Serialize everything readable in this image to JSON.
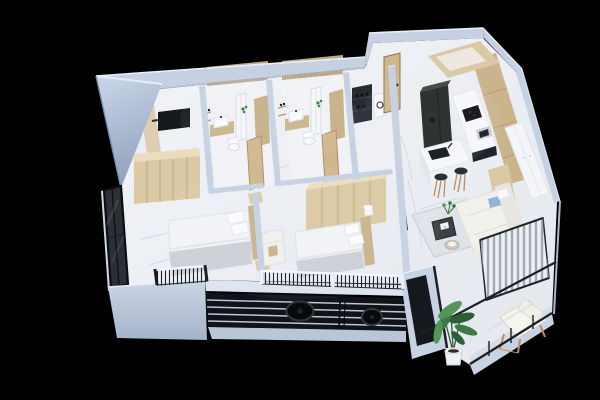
{
  "scene": {
    "kind": "isometric-3d-apartment-cutaway-render",
    "background": "black",
    "rooms": [
      {
        "name": "master-bedroom",
        "furniture": [
          "double-bed",
          "pillows",
          "gray-throw",
          "wardrobe",
          "wall-tv",
          "nightstand",
          "corner-glass-window",
          "juliet-railing"
        ]
      },
      {
        "name": "bedroom-2",
        "furniture": [
          "double-bed",
          "pillows",
          "wardrobe",
          "dresser",
          "chair",
          "table-lamp",
          "front-railing"
        ]
      },
      {
        "name": "bathroom-1",
        "furniture": [
          "wood-slat-wall",
          "mirror-cabinet",
          "vanity-sink",
          "wall-shelves",
          "toilet",
          "shower-partition",
          "wood-door",
          "plant-accent"
        ]
      },
      {
        "name": "bathroom-2",
        "furniture": [
          "wood-slat-wall",
          "mirror-cabinet",
          "vanity-sink",
          "wall-shelves",
          "toilet",
          "shower-partition",
          "wood-door",
          "plant-accent"
        ]
      },
      {
        "name": "utility-room",
        "furniture": [
          "dark-shelf-unit",
          "white-appliance"
        ]
      },
      {
        "name": "entry-hall",
        "furniture": [
          "entry-door"
        ]
      },
      {
        "name": "kitchen",
        "furniture": [
          "tall-dark-cabinet",
          "upper-cabinets",
          "counter-with-cooktop",
          "oven",
          "island-with-sink",
          "bar-stool",
          "bar-stool",
          "wood-cabinet-wall"
        ]
      },
      {
        "name": "living-room",
        "furniture": [
          "sofa",
          "blue-pillow",
          "rug",
          "coffee-table",
          "side-table",
          "small-plant",
          "wall-tv",
          "built-in-closet"
        ]
      },
      {
        "name": "balcony",
        "furniture": [
          "lounge-chair",
          "potted-banana-plant",
          "striped-privacy-screen",
          "glass-railing"
        ]
      },
      {
        "name": "service-ledge",
        "furniture": [
          "louver-grille",
          "condenser-fan-large",
          "condenser-fan-small",
          "open-trough"
        ]
      }
    ]
  },
  "palette": {
    "background": "#000000",
    "wall_band": "#c5d1e2",
    "wall_rim": "#e9eff8",
    "wall_shadow": "#93a5bf",
    "wall_face": "#e8edf5",
    "floor": "#eceef2",
    "floor_vein": "#d0d5dc",
    "fascia": "#c7d2e2",
    "under_fascia": "#b9c6d8",
    "louver_dark": "#101317",
    "louver_slat": "#c7d0dc",
    "fan_dark": "#07090b",
    "fan_ring": "#32383f",
    "trough_dark": "#15191d",
    "wood_light": "#dbc9a5",
    "wood_mid": "#c9b48c",
    "wood_dark": "#b59e78",
    "wood_seam": "#a98f68",
    "slat_wall": "#c3ad89",
    "door_wood": "#cfb68c",
    "cabinet_dark": "#232a28",
    "cabinet_dark_top": "#3a453f",
    "appliance_dark": "#0e1012",
    "counter": "#f6f7fa",
    "fixture": "#f8f9fb",
    "mirror": "#f4f6f8",
    "textile": "#f2f3f6",
    "throw_gray": "#ccd0d6",
    "pillow_blue": "#8fb3d9",
    "glass": "#2b3036",
    "frame_dark": "#0b0d10",
    "railing_dark": "#1d2126",
    "railing_white": "#f2f5f9",
    "rug": "#dfe2e6",
    "rug_border": "#d0d4da",
    "sofa": "#f1f0ec",
    "sofa_shade": "#e7e6e1",
    "table_dark": "#3b4046",
    "side_table": "#cfc9bd",
    "stool_seat": "#2a2f33",
    "stool_leg": "#b98f5f",
    "screen_base": "#eef0f3",
    "screen_stripe": "#98a2ac",
    "plant": "#3c7a45",
    "plant_dark": "#2c5f36",
    "plant_light": "#55955c",
    "pot": "#eef0f3"
  }
}
